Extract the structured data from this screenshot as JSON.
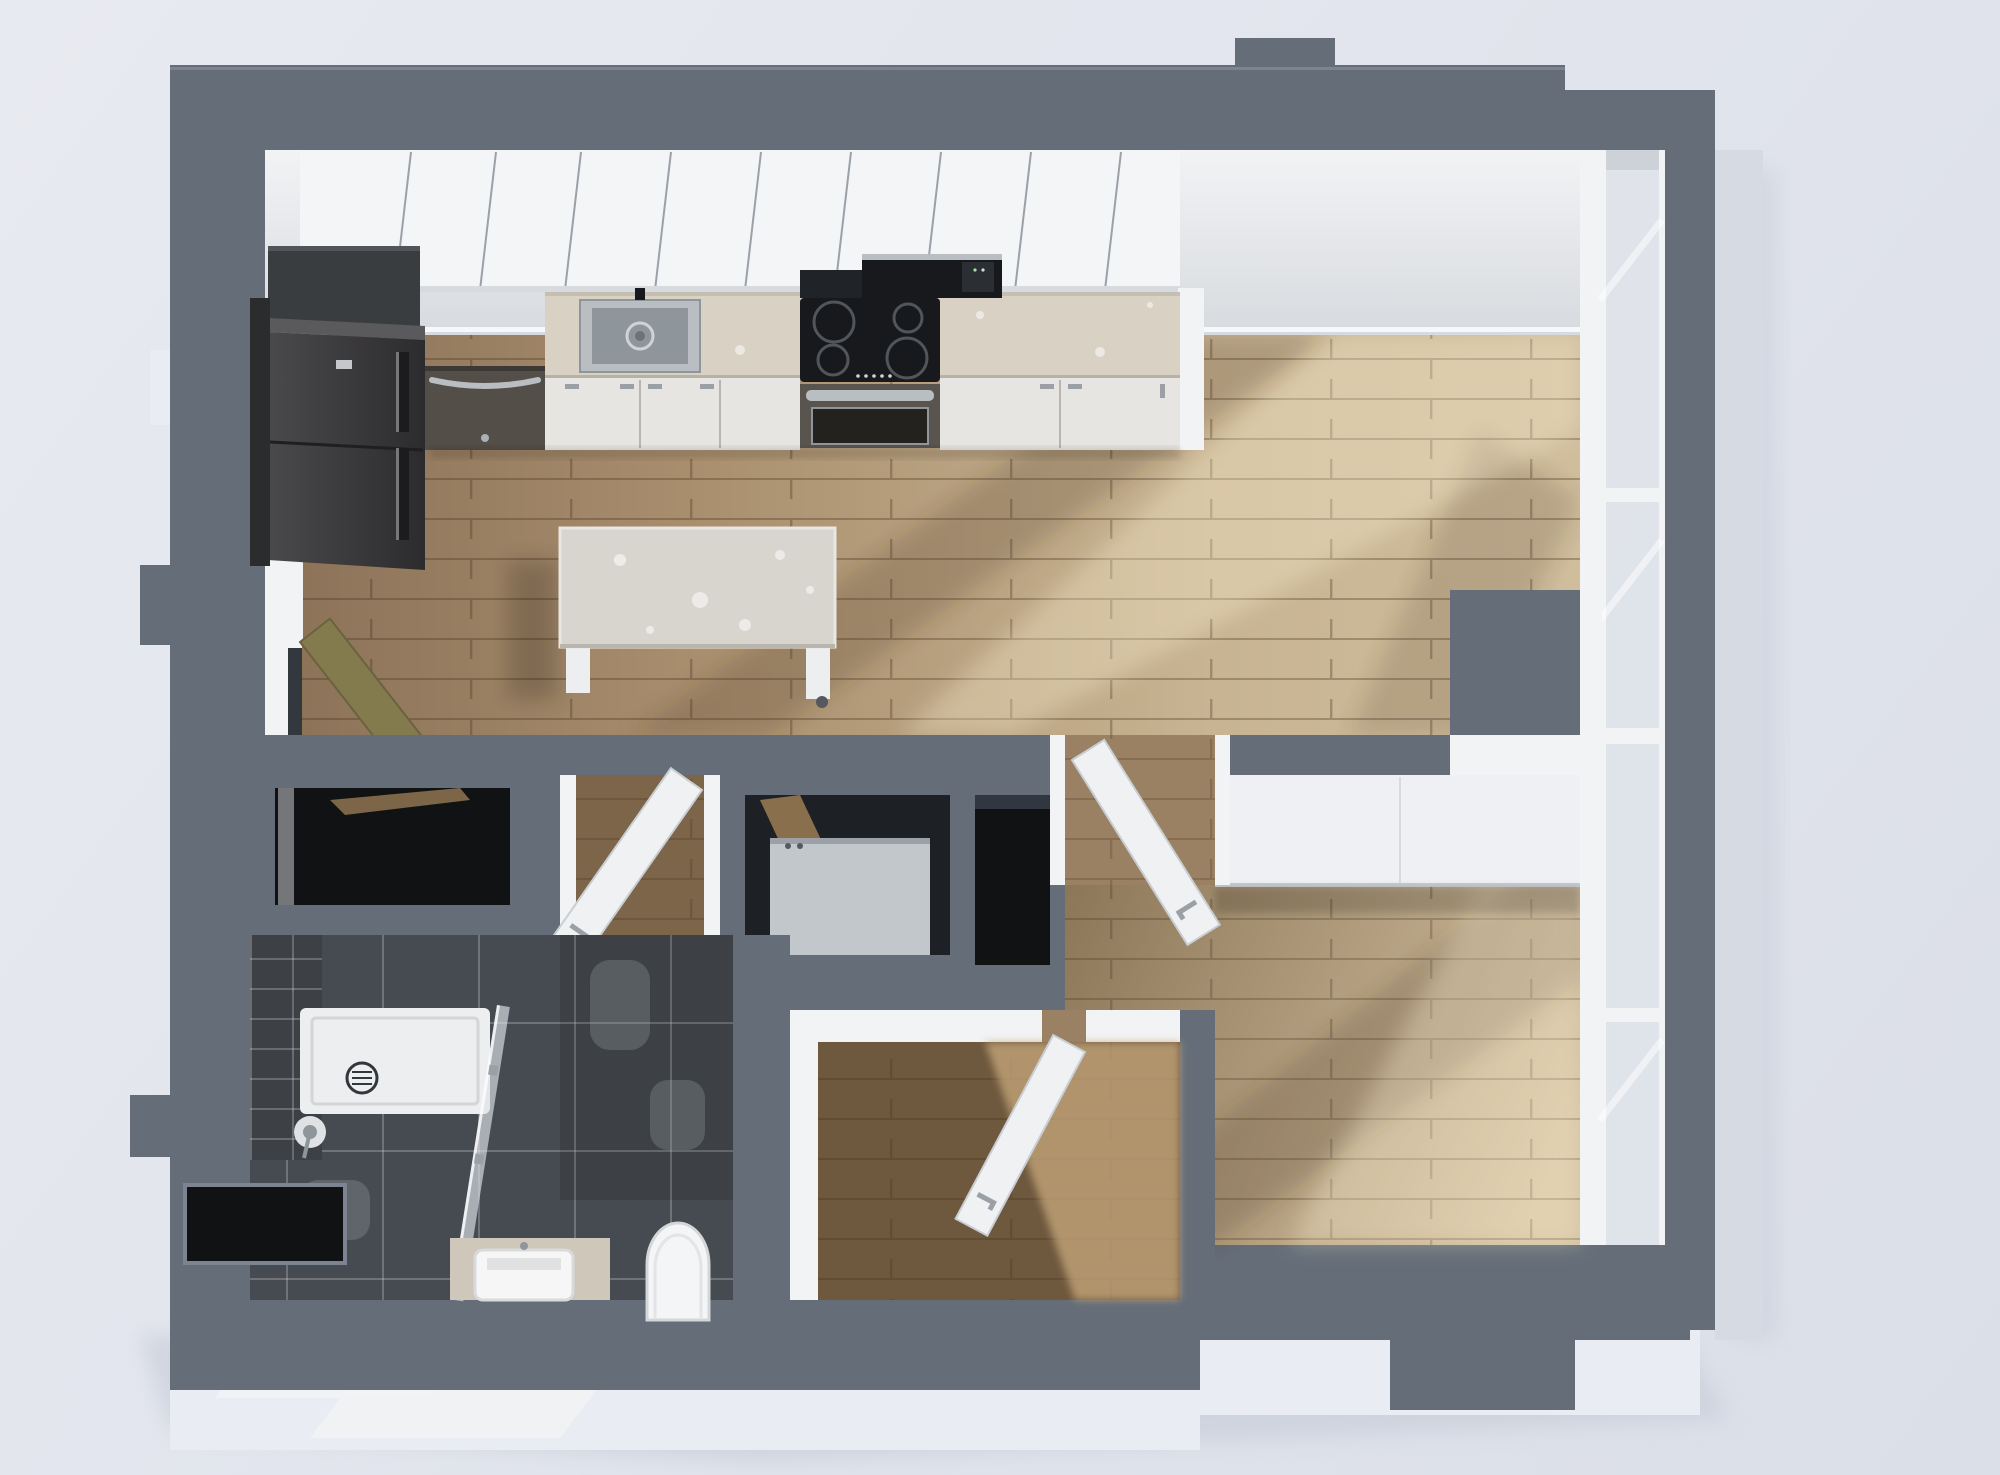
{
  "scene": {
    "type": "3d-floorplan-render",
    "view": "top-down axonometric cutaway",
    "description": "One-bedroom apartment 3D floor plan render with open-concept kitchen/living area, bedroom with walk-in closet, bathroom, entry and storage closets, and a floor-to-ceiling window wall on the right"
  },
  "rooms": [
    {
      "id": "kitchen-living",
      "kind": "open kitchen + living area",
      "floor": "wood planks, dark near kitchen fading to light oak"
    },
    {
      "id": "bedroom",
      "kind": "bedroom",
      "floor": "light oak planks with diagonal sun shadow"
    },
    {
      "id": "walk-in-closet",
      "kind": "walk-in closet",
      "floor": "dark wood planks with sunlit wedge"
    },
    {
      "id": "bathroom",
      "kind": "bathroom",
      "floor": "dark slate tile"
    },
    {
      "id": "hallway",
      "kind": "hall to bathroom",
      "floor": "medium wood planks"
    },
    {
      "id": "coat-closet",
      "kind": "dark storage closet with wood shelf"
    },
    {
      "id": "utility-closet",
      "kind": "utility closet with water-heater unit and wood shelf"
    },
    {
      "id": "dark-closet",
      "kind": "tall dark storage closet"
    }
  ],
  "fixtures": {
    "kitchen": [
      "refrigerator (dark, double handle)",
      "over-fridge dark cabinet",
      "white upper cabinet run with seams",
      "beige stone counter + backsplash",
      "undermount stainless sink with drain",
      "faucet",
      "dishwasher (dark bronze, steel handle)",
      "induction cooktop with 4 burner rings",
      "microwave + hood",
      "wall oven with steel handle",
      "white lower cabinets with handles",
      "kitchen island on white frame with casters"
    ],
    "bathroom": [
      "walk-in shower pan with round drain",
      "chrome shower fixture",
      "glass shower partition",
      "stone vanity with white rectangular basin",
      "toilet (oval seat)",
      "dark recessed wall niche"
    ],
    "doors": [
      "entry door (olive wood, swung open)",
      "bathroom door (white, swung open)",
      "bedroom door (white, swung open)",
      "walk-in-closet door (white, swung open)"
    ],
    "bedroom_fixtures": [
      "built-in wardrobe band along north wall"
    ],
    "windows": [
      "full-height glass window wall on east side with white mullions"
    ]
  },
  "colors": {
    "bg": "#dbdfe8",
    "bgLight": "#e8eaf1",
    "groundShadow": "#c5cad7",
    "wallGray": "#646d78",
    "wallGrayDark": "#525a64",
    "wallGrayLight": "#7b8490",
    "wallWhite": "#f2f3f5",
    "wallWhiteShade": "#d7dade",
    "exteriorLight": "#e9ecf2",
    "exteriorMid": "#d5dae3",
    "floorKitchen": "#8a7056",
    "floorMid": "#a98f6e",
    "floorLight": "#c8b492",
    "floorLight2": "#cfbd9c",
    "floorBedDark": "#8d7759",
    "floorBedLight": "#d4c2a1",
    "floorCloset": "#6e583e",
    "floorClosetLit": "#c8a97c",
    "floorHall": "#7c6549",
    "plankLine": "rgba(70,48,26,0.33)",
    "cabinetWhite": "#f4f5f6",
    "cabinetSeam": "#9aa1a8",
    "counterBeige": "#d9d2c4",
    "counterEdge": "#b8b2a6",
    "steel": "#b9bec3",
    "steelDark": "#8e959b",
    "applianceBlack": "#17191c",
    "applianceBronze": "#5a544e",
    "fridgeDark": "#4a494b",
    "fridgeDarker": "#2c2b2d",
    "islandTop": "#d8d4ce",
    "islandLeg": "#eceef0",
    "tileWallDark": "#3d4146",
    "tileFloor": "#464b51",
    "tileGrout": "rgba(255,255,255,0.22)",
    "showerWhite": "#eceeef",
    "glass": "#dfe4ea",
    "glassFrame": "#f1f3f5",
    "doorWhite": "#f0f1f3",
    "doorEdge": "#c9ced3",
    "doorOlive": "#837a4e",
    "doorOliveDark": "#6b6340",
    "handleGray": "#9aa0a6",
    "heaterGray": "#c2c7cc",
    "shelfWood": "#8a6f4c",
    "nicheDark": "#101214",
    "nicheDark2": "#1d2025",
    "sunShadow": "rgba(71,55,38,0.22)",
    "sunLight": "rgba(255,244,214,0.30)",
    "wardrobeWhite": "#eef0f3"
  }
}
